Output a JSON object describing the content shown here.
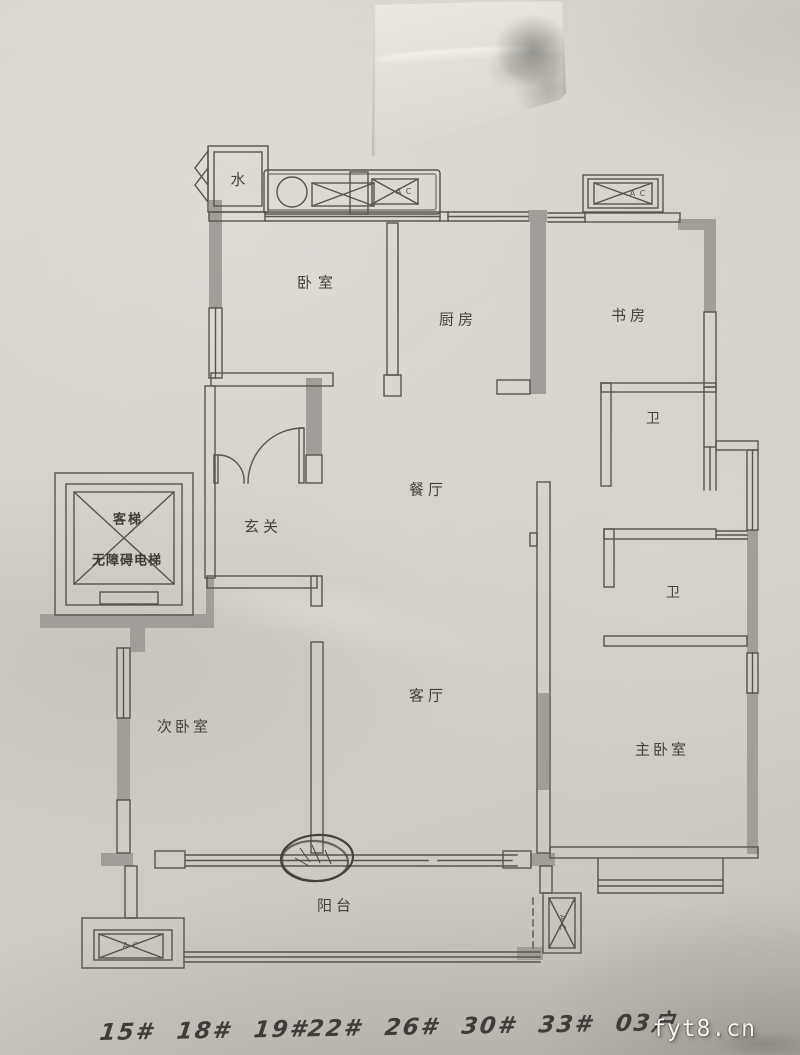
{
  "rooms": {
    "water": "水",
    "bedroom": "卧室",
    "kitchen": "厨房",
    "study": "书房",
    "bath_upper": "卫",
    "bath_lower": "卫",
    "dining": "餐厅",
    "entry": "玄关",
    "elevator_top": "客梯",
    "elevator_bottom": "无障碍电梯",
    "secondary_bedroom": "次卧室",
    "living": "客厅",
    "master_bedroom": "主卧室",
    "balcony": "阳台"
  },
  "equipment": {
    "ac_top": "A C",
    "ac_top_right": "A C",
    "ac_bottom_left": "A C",
    "ac_balcony_right": "A C"
  },
  "annotations": {
    "handwritten_units": "15# 18# 19#22# 26# 30# 33# 03户",
    "watermark": "fyt8.cn"
  },
  "colors": {
    "paper": "#d3cfc8",
    "wall_line": "#57544e",
    "wall_fill": "#a19e99",
    "ink": "#3e3d39",
    "pen_annotation": "#45423c",
    "watermark_text": "#f6f5f1"
  }
}
